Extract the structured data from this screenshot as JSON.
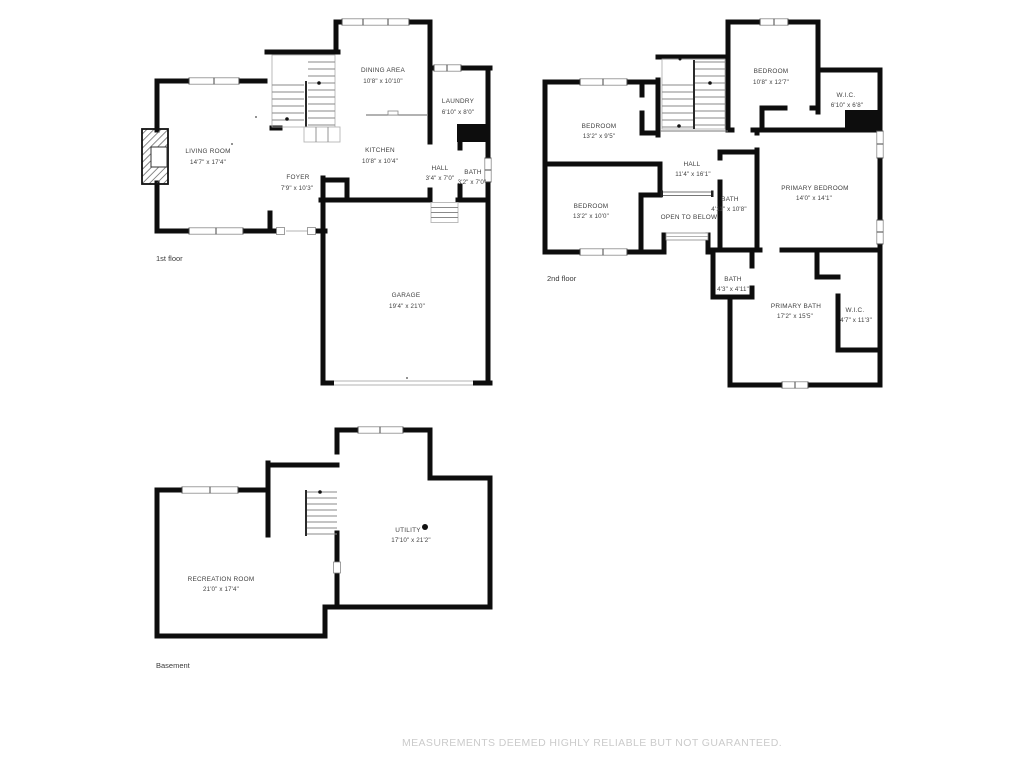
{
  "document": {
    "type": "floor-plan",
    "background": "#ffffff"
  },
  "colors": {
    "wall": "#0d0d0d",
    "room_text": "#3f3f3f",
    "floor_label_text": "#3a3a3a",
    "disclaimer_text": "#cbcbcb"
  },
  "floors": {
    "first": {
      "label": "1st floor",
      "rooms": {
        "dining_area": {
          "name": "DINING AREA",
          "dims": "10'8\" x 10'10\""
        },
        "laundry": {
          "name": "LAUNDRY",
          "dims": "6'10\" x 8'0\""
        },
        "living_room": {
          "name": "LIVING ROOM",
          "dims": "14'7\" x 17'4\""
        },
        "kitchen": {
          "name": "KITCHEN",
          "dims": "10'8\" x 10'4\""
        },
        "foyer": {
          "name": "FOYER",
          "dims": "7'9\" x 10'3\""
        },
        "hall": {
          "name": "HALL",
          "dims": "3'4\" x 7'0\""
        },
        "bath": {
          "name": "BATH",
          "dims": "3'2\" x 7'0\""
        },
        "garage": {
          "name": "GARAGE",
          "dims": "19'4\" x 21'0\""
        }
      }
    },
    "second": {
      "label": "2nd floor",
      "rooms": {
        "bedroom_top": {
          "name": "BEDROOM",
          "dims": "10'8\" x 12'7\""
        },
        "wic_top": {
          "name": "W.I.C.",
          "dims": "6'10\" x 6'8\""
        },
        "bedroom_upper_left": {
          "name": "BEDROOM",
          "dims": "13'2\" x 9'5\""
        },
        "hall": {
          "name": "HALL",
          "dims": "11'4\" x 16'1\""
        },
        "bath_upper": {
          "name": "BATH",
          "dims": "4'11\" x 10'8\""
        },
        "primary_bedroom": {
          "name": "PRIMARY BEDROOM",
          "dims": "14'0\" x 14'1\""
        },
        "bedroom_lower_left": {
          "name": "BEDROOM",
          "dims": "13'2\" x 10'0\""
        },
        "open_to_below": {
          "name": "OPEN TO BELOW"
        },
        "bath_small": {
          "name": "BATH",
          "dims": "4'3\" x 4'11\""
        },
        "primary_bath": {
          "name": "PRIMARY BATH",
          "dims": "17'2\" x 15'5\""
        },
        "wic_lower": {
          "name": "W.I.C.",
          "dims": "4'7\" x 11'3\""
        }
      }
    },
    "basement": {
      "label": "Basement",
      "rooms": {
        "recreation_room": {
          "name": "RECREATION ROOM",
          "dims": "21'0\" x 17'4\""
        },
        "utility": {
          "name": "UTILITY",
          "dims": "17'10\" x 21'2\""
        }
      }
    }
  },
  "disclaimer": {
    "text": "MEASUREMENTS DEEMED HIGHLY RELIABLE BUT NOT GUARANTEED."
  }
}
